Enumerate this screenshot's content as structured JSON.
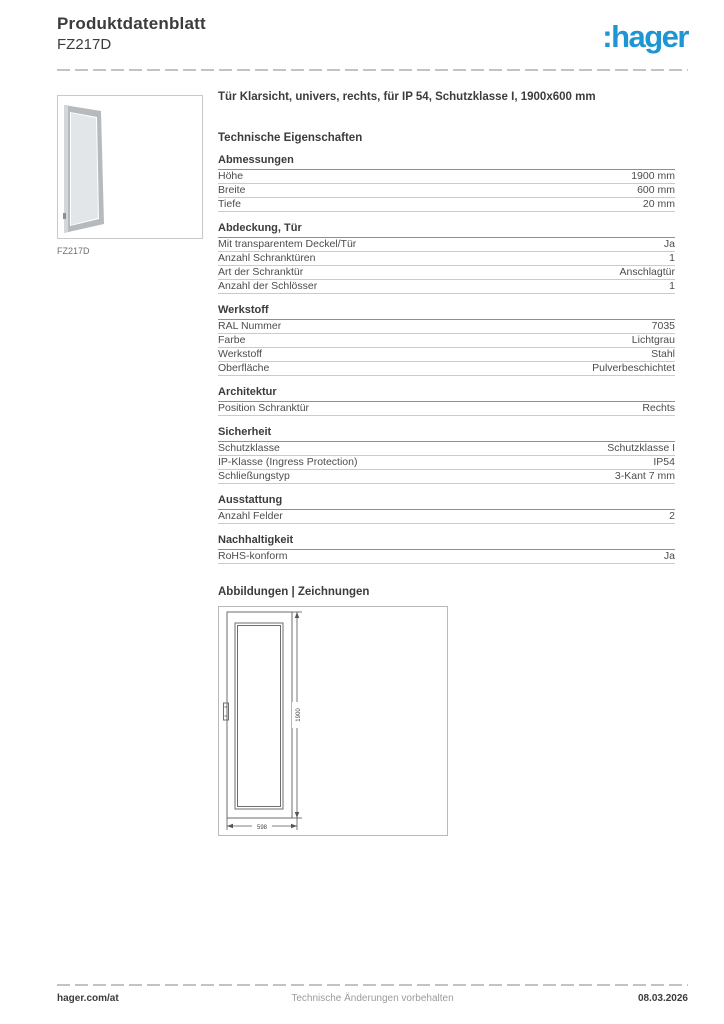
{
  "header": {
    "title": "Produktdatenblatt",
    "reference": "FZ217D",
    "logo_text": ":hager"
  },
  "product": {
    "title": "Tür Klarsicht, univers, rechts, für IP 54, Schutzklasse I, 1900x600 mm",
    "image_caption": "FZ217D"
  },
  "tech_heading": "Technische Eigenschaften",
  "sections": [
    {
      "name": "Abmessungen",
      "rows": [
        {
          "label": "Höhe",
          "value": "1900 mm"
        },
        {
          "label": "Breite",
          "value": "600 mm"
        },
        {
          "label": "Tiefe",
          "value": "20 mm"
        }
      ]
    },
    {
      "name": "Abdeckung, Tür",
      "rows": [
        {
          "label": "Mit transparentem Deckel/Tür",
          "value": "Ja"
        },
        {
          "label": "Anzahl Schranktüren",
          "value": "1"
        },
        {
          "label": "Art der Schranktür",
          "value": "Anschlagtür"
        },
        {
          "label": "Anzahl der Schlösser",
          "value": "1"
        }
      ]
    },
    {
      "name": "Werkstoff",
      "rows": [
        {
          "label": "RAL Nummer",
          "value": "7035"
        },
        {
          "label": "Farbe",
          "value": "Lichtgrau"
        },
        {
          "label": "Werkstoff",
          "value": "Stahl"
        },
        {
          "label": "Oberfläche",
          "value": "Pulverbeschichtet"
        }
      ]
    },
    {
      "name": "Architektur",
      "rows": [
        {
          "label": "Position Schranktür",
          "value": "Rechts"
        }
      ]
    },
    {
      "name": "Sicherheit",
      "rows": [
        {
          "label": "Schutzklasse",
          "value": "Schutzklasse I"
        },
        {
          "label": "IP-Klasse (Ingress Protection)",
          "value": "IP54"
        },
        {
          "label": "Schließungstyp",
          "value": "3-Kant 7 mm"
        }
      ]
    },
    {
      "name": "Ausstattung",
      "rows": [
        {
          "label": "Anzahl Felder",
          "value": "2"
        }
      ]
    },
    {
      "name": "Nachhaltigkeit",
      "rows": [
        {
          "label": "RoHS-konform",
          "value": "Ja"
        }
      ]
    }
  ],
  "drawings_heading": "Abbildungen | Zeichnungen",
  "drawing": {
    "height_label": "1900",
    "width_label": "598"
  },
  "footer": {
    "left": "hager.com/at",
    "center": "Technische Änderungen vorbehalten",
    "right": "08.03.2026"
  },
  "colors": {
    "brand_blue": "#1e96d2",
    "text_dark": "#3c3c3b",
    "row_line": "#cbcbcb",
    "section_line": "#8f8f8f"
  }
}
